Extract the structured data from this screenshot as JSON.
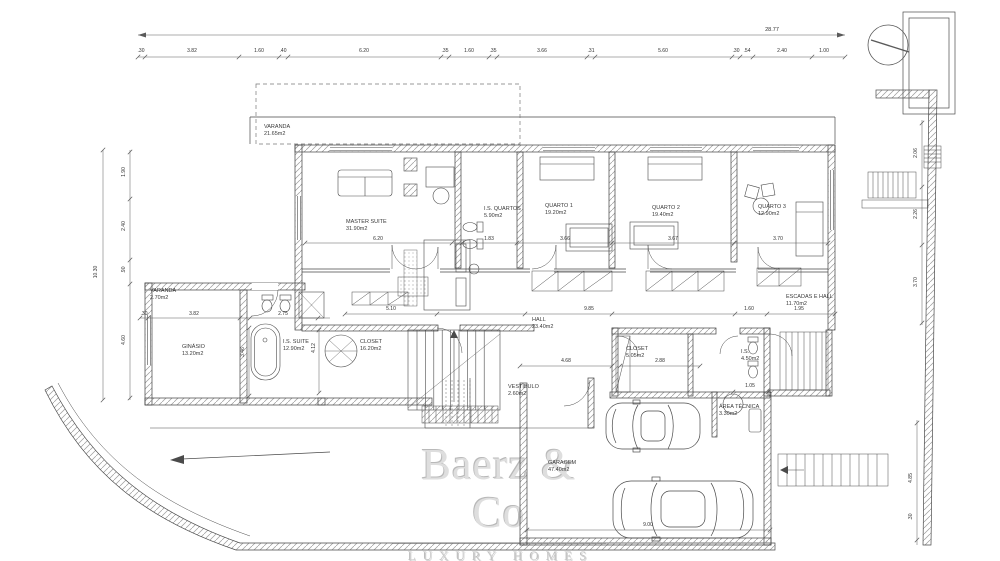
{
  "watermark": {
    "brand": "Baerz & Co",
    "tagline": "LUXURY HOMES"
  },
  "rooms": {
    "varanda_top": {
      "name": "VARANDA",
      "area": "21.65m2"
    },
    "master_suite": {
      "name": "MASTER SUITE",
      "area": "31.90m2"
    },
    "is_quartos": {
      "name": "I.S. QUARTOS",
      "area": "5.90m2"
    },
    "quarto1": {
      "name": "QUARTO 1",
      "area": "19.20m2"
    },
    "quarto2": {
      "name": "QUARTO 2",
      "area": "19.40m2"
    },
    "quarto3": {
      "name": "QUARTO 3",
      "area": "12.90m2"
    },
    "varanda_left": {
      "name": "VARANDA",
      "area": "2.70m2"
    },
    "ginasio": {
      "name": "GINÁSIO",
      "area": "13.20m2"
    },
    "is_suite": {
      "name": "I.S. SUITE",
      "area": "12.90m2"
    },
    "closet_suite": {
      "name": "CLOSET",
      "area": "16.20m2"
    },
    "hall": {
      "name": "HALL",
      "area": "23.40m2"
    },
    "vestibulo": {
      "name": "VESTÍBULO",
      "area": "2.60m2"
    },
    "closet_hall": {
      "name": "CLOSET",
      "area": "5.05m2"
    },
    "is_hall": {
      "name": "I.S.",
      "area": "4.50m2"
    },
    "escadas": {
      "name": "ESCADAS E HALL",
      "area": "11.70m2"
    },
    "area_tecnica": {
      "name": "ÁREA TÉCNICA",
      "area": "3.30m2"
    },
    "garagem": {
      "name": "GARAGEM",
      "area": "47.40m2"
    }
  },
  "dimensions": {
    "overall_width": "28.77",
    "top_segments": [
      ".30",
      "3.82",
      "1.60",
      ".40",
      "6.20",
      ".35",
      "1.60",
      ".35",
      "3.66",
      ".31",
      "5.60",
      ".30",
      ".54",
      "2.40",
      "1.00"
    ],
    "left_overall": "10.30",
    "left_segments": [
      "1.90",
      "2.40",
      ".90",
      "4.60"
    ],
    "right_segments": [
      "2.06",
      "2.26",
      "3.70"
    ],
    "right_lower": [
      "4.85",
      ".30"
    ],
    "interior": {
      "master_width": "6.20",
      "is_quartos_width": "1.83",
      "quarto1_width": "3.66",
      "quarto2_width": "3.67",
      "quarto3_width": "3.70",
      "varanda_offset": ".30",
      "ginasio_width": "3.82",
      "is_suite_width": "2.75",
      "ginasio_height": "3.46",
      "closet_height": "4.12",
      "hall_left": "5.10",
      "hall_width": "9.85",
      "hall_opening": "4.68",
      "closet_hall_width": "2.88",
      "is_hall_width": "1.60",
      "escadas_width": "1.95",
      "vestibule_width": "1.05",
      "garage_width": "9.00"
    }
  }
}
